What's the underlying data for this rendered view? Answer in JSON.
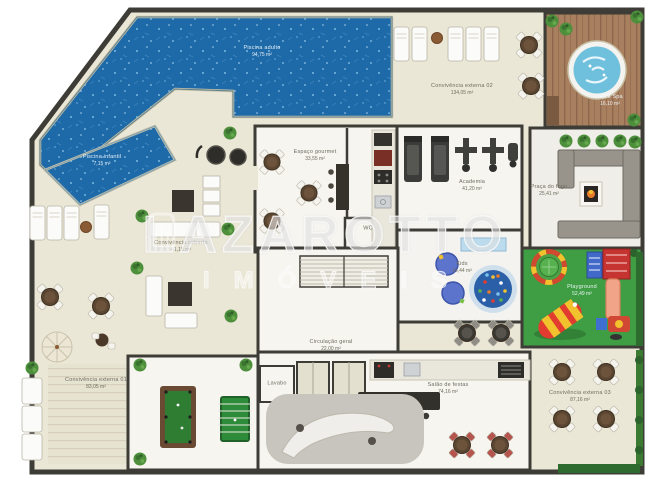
{
  "watermark": {
    "brand": "LAZAROTTO",
    "subtitle": "IMÓVEIS"
  },
  "colors": {
    "deck": "#ebe7d6",
    "wall": "#3e3c36",
    "pool": "#1e6aa8",
    "room": "#f6f5f0",
    "wood": "#a87f5f",
    "lawn": "#3f9e44",
    "felt": "#2f7d32",
    "spa_water": "#6fc0dd"
  },
  "rooms": [
    {
      "id": "piscina-adulto",
      "name": "Piscina adulto",
      "area": "94,75 m²",
      "x": 262,
      "y": 52,
      "tone": "light"
    },
    {
      "id": "piscina-infantil",
      "name": "Piscina infantil",
      "area": "7,15 m²",
      "x": 102,
      "y": 161,
      "tone": "light"
    },
    {
      "id": "convivencia-externa-02",
      "name": "Convivência externa 02",
      "area": "134,05 m²",
      "x": 462,
      "y": 90,
      "tone": "dark"
    },
    {
      "id": "deck-spa",
      "name": "Deck Spa",
      "area": "16,10 m²",
      "x": 610,
      "y": 101,
      "tone": "light"
    },
    {
      "id": "espaco-gourmet",
      "name": "Espaço gourmet",
      "area": "33,55 m²",
      "x": 315,
      "y": 156,
      "tone": "dark"
    },
    {
      "id": "academia",
      "name": "Academia",
      "area": "41,20 m²",
      "x": 472,
      "y": 186,
      "tone": "dark"
    },
    {
      "id": "praca-do-fogo",
      "name": "Praça do fogo",
      "area": "25,41 m²",
      "x": 549,
      "y": 191,
      "tone": "dark"
    },
    {
      "id": "kids",
      "name": "Kids",
      "area": "15,44 m²",
      "x": 462,
      "y": 268,
      "tone": "dark"
    },
    {
      "id": "playground",
      "name": "Playground",
      "area": "52,49 m²",
      "x": 582,
      "y": 291,
      "tone": "light"
    },
    {
      "id": "convivencia-coberta",
      "name": "Convivência coberta",
      "area": "41,15 m²",
      "x": 181,
      "y": 247,
      "tone": "dark"
    },
    {
      "id": "convivencia-externa-01",
      "name": "Convivência externa 01",
      "area": "83,05 m²",
      "x": 96,
      "y": 384,
      "tone": "dark"
    },
    {
      "id": "circulacao-geral",
      "name": "Circulação geral",
      "area": "22,00 m²",
      "x": 331,
      "y": 346,
      "tone": "dark"
    },
    {
      "id": "salao-de-festas",
      "name": "Salão de festas",
      "area": "74,16 m²",
      "x": 448,
      "y": 389,
      "tone": "dark"
    },
    {
      "id": "convivencia-externa-03",
      "name": "Convivência externa 03",
      "area": "87,16 m²",
      "x": 580,
      "y": 397,
      "tone": "dark"
    },
    {
      "id": "wc",
      "name": "WC",
      "area": "",
      "x": 368,
      "y": 229,
      "tone": "dark"
    },
    {
      "id": "lavabo",
      "name": "Lavabo",
      "area": "",
      "x": 277,
      "y": 384,
      "tone": "dark"
    }
  ]
}
